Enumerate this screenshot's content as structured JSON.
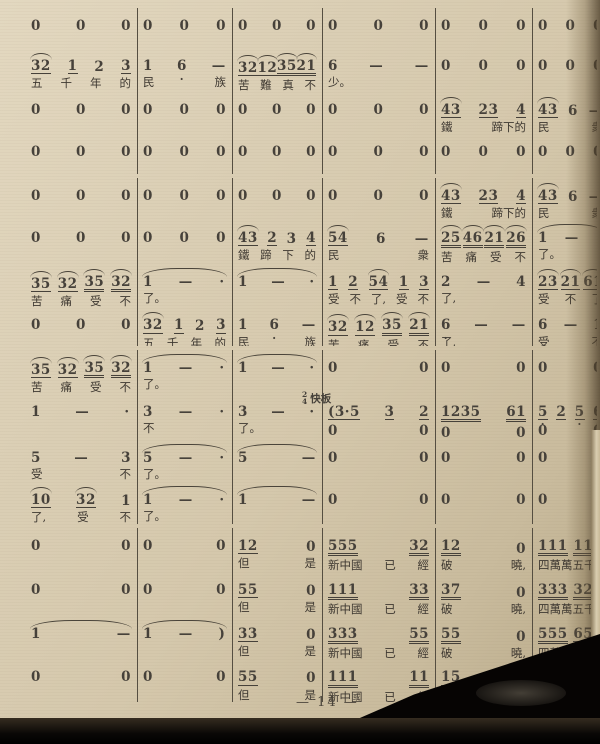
{
  "page": {
    "number_label": "— 14 —"
  },
  "tempo": {
    "time_signature": "2/4",
    "label": "快板"
  },
  "colors": {
    "paper": "#d8ccb2",
    "ink": "#46413a",
    "photo_edge": "#0b0907"
  },
  "score": {
    "notation": "jianpu",
    "token_legend": "^=slur-arc, _=eighth underline, __=sixteenth underline, '=dot above, ,=dot below, -=dash, ·=aug dot",
    "systems": [
      {
        "rows": [
          {
            "cells": [
              {
                "n": "0 0 0"
              },
              {
                "n": "0 0 0"
              },
              {
                "n": "0 0 0"
              },
              {
                "n": "0 0 0"
              },
              {
                "n": "0 0 0"
              },
              {
                "n": "0 0 0"
              }
            ]
          },
          {
            "cells": [
              {
                "n": "^32_ 1_ 2 3_",
                "l": "五 千 年 的"
              },
              {
                "n": "1 6, -",
                "l": "民 族"
              },
              {
                "n": "^32_ ^12_ ^35__ ^21__",
                "l": "苦 難 真 不"
              },
              {
                "n": "6 - -",
                "l": "少。"
              },
              {
                "n": "0 0 0"
              },
              {
                "n": "0 0 0"
              }
            ]
          },
          {
            "cells": [
              {
                "n": "0 0 0"
              },
              {
                "n": "0 0 0"
              },
              {
                "n": "0 0 0"
              },
              {
                "n": "0 0 0"
              },
              {
                "n": "^43_ 23_ 4_",
                "l": "鐵 蹄下的"
              },
              {
                "n": "^43_ 6 -",
                "l": "民 衆"
              }
            ]
          },
          {
            "cells": [
              {
                "n": "0 0 0"
              },
              {
                "n": "0 0 0"
              },
              {
                "n": "0 0 0"
              },
              {
                "n": "0 0 0"
              },
              {
                "n": "0 0 0"
              },
              {
                "n": "0 0 0"
              }
            ]
          }
        ]
      },
      {
        "rows": [
          {
            "cells": [
              {
                "n": "0 0 0"
              },
              {
                "n": "0 0 0"
              },
              {
                "n": "0 0 0"
              },
              {
                "n": "0 0 0"
              },
              {
                "n": "^43_ 23_ 4_",
                "l": "鐵 蹄下的"
              },
              {
                "n": "^43_ 6 -",
                "l": "民 衆"
              }
            ]
          },
          {
            "cells": [
              {
                "n": "0 0 0"
              },
              {
                "n": "0 0 0"
              },
              {
                "n": "^43_ 2_ 3 4_",
                "l": "鐵 蹄 下 的"
              },
              {
                "n": "^54_ 6 -",
                "l": "民 衆"
              },
              {
                "n": "^25__ ^46__ ^21__ ^26__",
                "l": "苦 痛 受 不"
              },
              {
                "n": "1 - ·",
                "l": "了。",
                "tie": true
              }
            ]
          },
          {
            "cells": [
              {
                "n": "^35_ ^32_ ^35__ ^32__",
                "l": "苦 痛 受 不"
              },
              {
                "n": "1 - ·",
                "l": "了。",
                "tie": true
              },
              {
                "n": "1 - ·",
                "tie": true
              },
              {
                "n": "1_ 2_ ^54_ 1_ 3_",
                "l": "受 不 了, 受 不"
              },
              {
                "n": "2 - 4",
                "l": "了,"
              },
              {
                "n": "^23_ ^21_ ^61_",
                "l": "受 不 了"
              }
            ]
          },
          {
            "cells": [
              {
                "n": "0 0 0"
              },
              {
                "n": "^32_ 1_ 2 3_",
                "l": "五 千 年 的"
              },
              {
                "n": "1 6, -",
                "l": "民 族"
              },
              {
                "n": "^32_ ^12_ ^35__ ^21__",
                "l": "苦 痛 受 不"
              },
              {
                "n": "6, - -",
                "l": "了,"
              },
              {
                "n": "6 - 1",
                "l": "受 不"
              }
            ]
          }
        ]
      },
      {
        "rows": [
          {
            "cells": [
              {
                "n": "^35_ ^32_ ^35__ ^32__",
                "l": "苦 痛 受 不"
              },
              {
                "n": "1 - ·",
                "l": "了。",
                "tie": true
              },
              {
                "n": "1 - ·",
                "tie": true
              },
              {
                "n": "0 0"
              },
              {
                "n": "0 0"
              },
              {
                "n": "0 0"
              }
            ]
          },
          {
            "cells": [
              {
                "n": "1 - ·"
              },
              {
                "n": "3 - ·",
                "l": "不"
              },
              {
                "n": "3 - ·",
                "l": "了。"
              },
              {
                "n": "(3·5_ 3_ 2_",
                "n2": "0 0",
                "pre": true
              },
              {
                "n": "1235__ 61__",
                "n2": "0 0"
              },
              {
                "n": "5,_ 2_ 5,_ 6,_",
                "n2": "0 0"
              }
            ]
          },
          {
            "cells": [
              {
                "n": "5 - 3",
                "l": "受 不"
              },
              {
                "n": "5 - ·",
                "l": "了。",
                "tie": true
              },
              {
                "n": "5 -",
                "tie": true
              },
              {
                "n": "0 0"
              },
              {
                "n": "0 0"
              },
              {
                "n": "0 0"
              }
            ]
          },
          {
            "cells": [
              {
                "n": "^10_ ^32_ 1",
                "l": "了, 受 不"
              },
              {
                "n": "1 - ·",
                "l": "了。",
                "tie": true
              },
              {
                "n": "1 -",
                "tie": true
              },
              {
                "n": "0 0"
              },
              {
                "n": "0 0"
              },
              {
                "n": "0 0"
              }
            ]
          }
        ]
      },
      {
        "rows": [
          {
            "cells": [
              {
                "n": "0 0"
              },
              {
                "n": "0 0"
              },
              {
                "n": "12_ 0",
                "l": "但 是"
              },
              {
                "n": "555__ 32__",
                "l": "新中國 已 經"
              },
              {
                "n": "12__ 0",
                "l": "破 曉,"
              },
              {
                "n": "111__ 111__",
                "l": "四萬萬五千萬"
              }
            ]
          },
          {
            "cells": [
              {
                "n": "0 0"
              },
              {
                "n": "0 0"
              },
              {
                "n": "55_ 0",
                "l": "但 是"
              },
              {
                "n": "111__ 33__",
                "l": "新中國 已 經"
              },
              {
                "n": "37__ 0",
                "l": "破 曉,"
              },
              {
                "n": "333__ 322__",
                "l": "四萬萬五千萬"
              }
            ]
          },
          {
            "cells": [
              {
                "n": "1 -",
                "tie": true
              },
              {
                "n": "1 - )",
                "tie": true
              },
              {
                "n": "33_ 0",
                "l": "但 是"
              },
              {
                "n": "333__ 55__",
                "l": "新中國 已 經"
              },
              {
                "n": "55__ 0",
                "l": "破 曉,"
              },
              {
                "n": "555__ 654__",
                "l": "四萬萬五千萬"
              }
            ]
          },
          {
            "cells": [
              {
                "n": "0 0"
              },
              {
                "n": "0 0"
              },
              {
                "n": "55_ 0",
                "l": "但 是"
              },
              {
                "n": "111__ 11__",
                "l": "新中國 已 經"
              },
              {
                "n": "15__ 0",
                "l": "破 曉,"
              },
              {
                "n": "111__ 111__",
                "l": "四萬萬五千萬"
              }
            ]
          }
        ]
      }
    ],
    "barline_offsets": [
      112,
      207,
      297,
      410,
      507
    ]
  }
}
